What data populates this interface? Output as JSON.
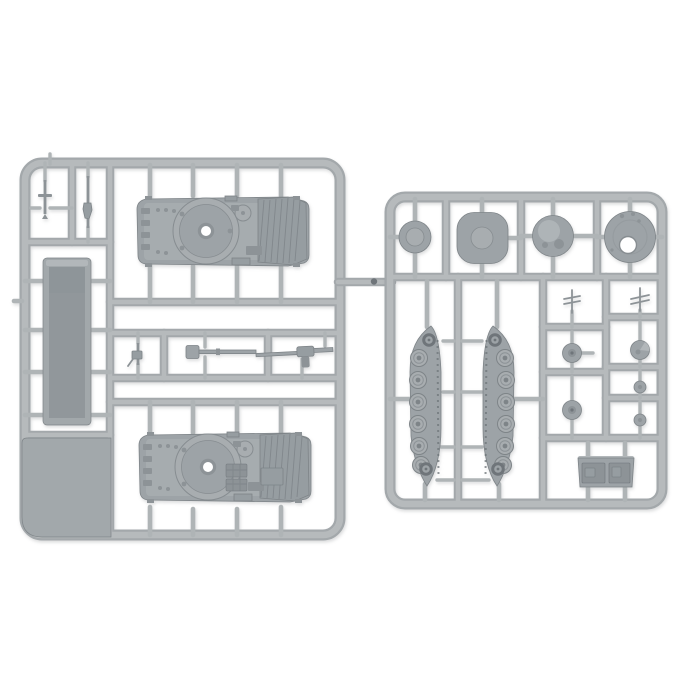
{
  "image": {
    "description": "Product photograph of two light-grey injection-moulded plastic model sprues holding 1:100 tank miniature parts, shot on a plain white background",
    "background": "#ffffff"
  },
  "colors": {
    "bg": "#ffffff",
    "runner": "#b6babc",
    "runner_shade": "#a3a8ab",
    "gate": "#afb4b6",
    "part": "#9da3a7",
    "part_light": "#a8adb0",
    "part_lighter": "#b2b7ba",
    "part_dark": "#8d9397",
    "part_darker": "#6f757a",
    "part_edge": "#7e8488",
    "deck": "#969da1",
    "panel": "#a2a8ab",
    "tray_inner": "#91979b",
    "hole_ring": "#878d91"
  },
  "sprues": {
    "left": {
      "label": "left sprue - hull frame",
      "parts": [
        {
          "name": "tank-hull-top-upper",
          "qty": 1
        },
        {
          "name": "tank-hull-top-lower",
          "qty": 1
        },
        {
          "name": "hull-tub",
          "qty": 1
        },
        {
          "name": "flotation-panel",
          "qty": 1
        },
        {
          "name": "dagger-rod",
          "qty": 1
        },
        {
          "name": "pin-rod",
          "qty": 1
        },
        {
          "name": "machine-gun",
          "qty": 1
        },
        {
          "name": "long-gun-barrel",
          "qty": 1
        },
        {
          "name": "gun-with-breech",
          "qty": 1
        }
      ]
    },
    "right": {
      "label": "right sprue - turret and running gear frame",
      "parts": [
        {
          "name": "turret-disc-small",
          "qty": 1
        },
        {
          "name": "turret-disc-large",
          "qty": 1
        },
        {
          "name": "turret-top-hatch-disc",
          "qty": 1
        },
        {
          "name": "turret-base-plate-with-hole",
          "qty": 1
        },
        {
          "name": "track-run",
          "qty": 2
        },
        {
          "name": "whip-antenna",
          "qty": 2
        },
        {
          "name": "road-wheel",
          "qty": 2
        },
        {
          "name": "hatch-wheel",
          "qty": 1
        },
        {
          "name": "small-wheel",
          "qty": 2
        },
        {
          "name": "stowage-bin",
          "qty": 1
        }
      ]
    }
  }
}
